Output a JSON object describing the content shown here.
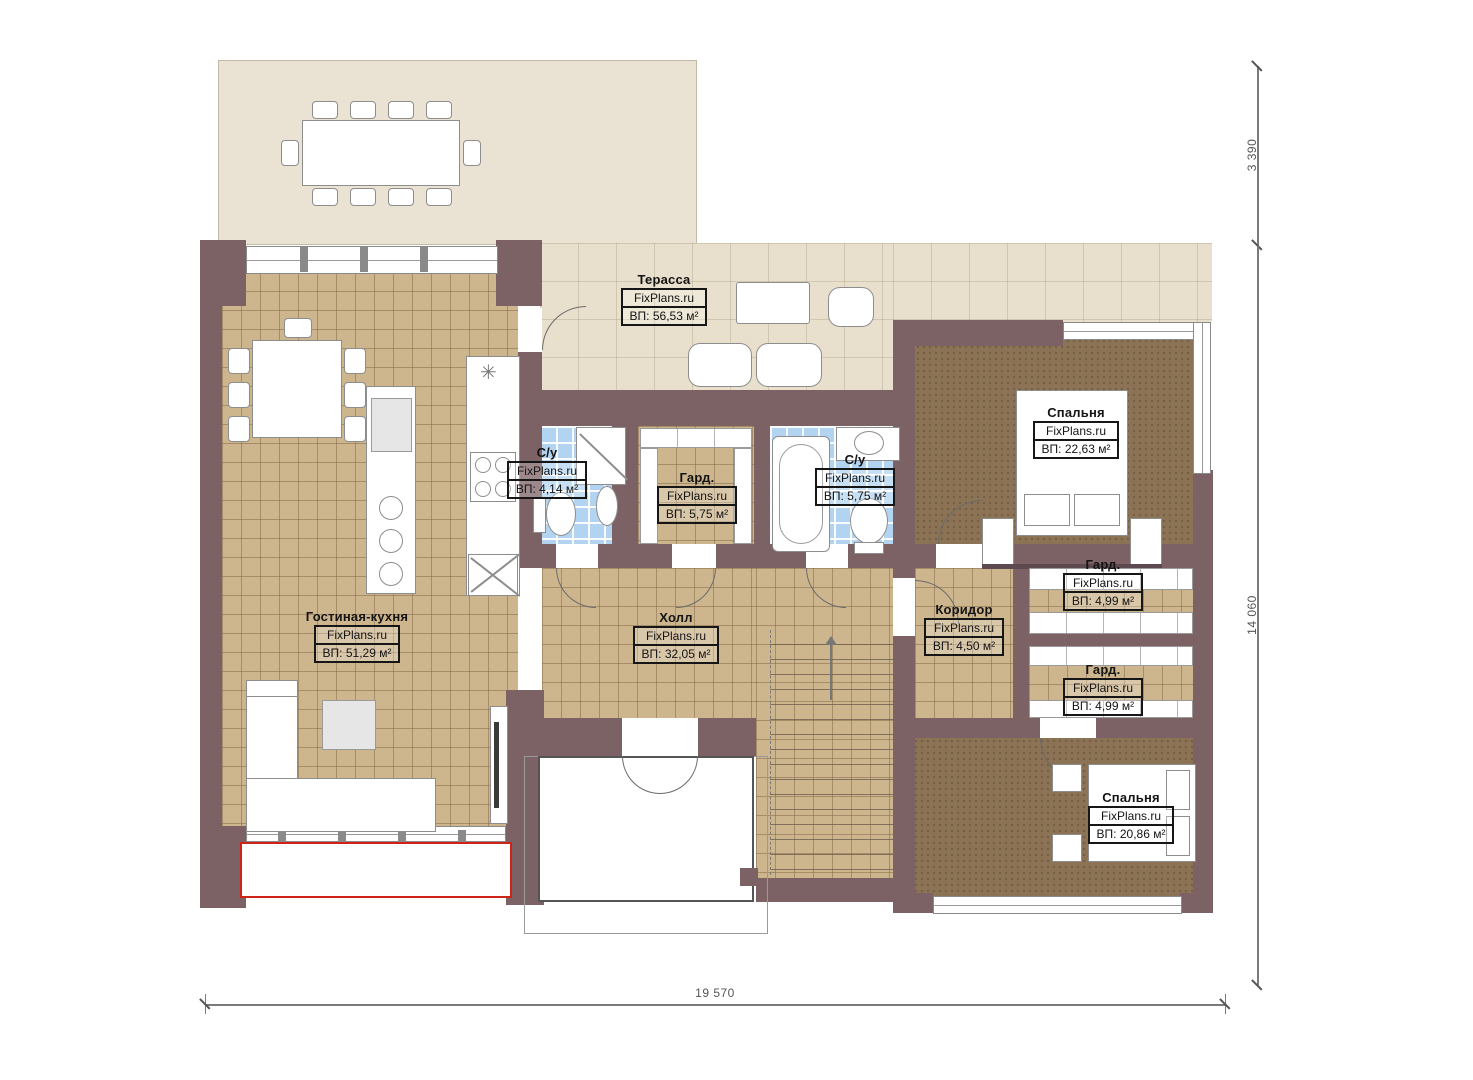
{
  "title": "План первого этажа",
  "watermark": "FixPlans.ru",
  "rooms": [
    {
      "name": "Терасса",
      "watermark": "FixPlans.ru",
      "area": "ВП: 56,53 м²"
    },
    {
      "name": "Спальня",
      "watermark": "FixPlans.ru",
      "area": "ВП: 22,63 м²"
    },
    {
      "name": "С/у",
      "watermark": "FixPlans.ru",
      "area": "ВП: 4,14 м²"
    },
    {
      "name": "Гард.",
      "watermark": "FixPlans.ru",
      "area": "ВП: 5,75 м²"
    },
    {
      "name": "С/у",
      "watermark": "FixPlans.ru",
      "area": "ВП: 5,75 м²"
    },
    {
      "name": "Гостиная-кухня",
      "watermark": "FixPlans.ru",
      "area": "ВП: 51,29 м²"
    },
    {
      "name": "Холл",
      "watermark": "FixPlans.ru",
      "area": "ВП: 32,05 м²"
    },
    {
      "name": "Коридор",
      "watermark": "FixPlans.ru",
      "area": "ВП: 4,50 м²"
    },
    {
      "name": "Гард.",
      "watermark": "FixPlans.ru",
      "area": "ВП: 4,99 м²"
    },
    {
      "name": "Гард.",
      "watermark": "FixPlans.ru",
      "area": "ВП: 4,99 м²"
    },
    {
      "name": "Спальня",
      "watermark": "FixPlans.ru",
      "area": "ВП: 20,86 м²"
    }
  ],
  "dimensions": {
    "right_top": "3 390",
    "right_full": "14 060",
    "bottom": "19 570"
  },
  "icons": {
    "cooktop_star": "✳"
  },
  "colors": {
    "wall": "#7c6165",
    "tile": "#cdb58e",
    "carpet": "#8c7355",
    "bath_tile": "#b3d4f0",
    "terrace": "#e8e0cd",
    "deck": "#eae3d4",
    "highlight_red": "#d02318"
  }
}
